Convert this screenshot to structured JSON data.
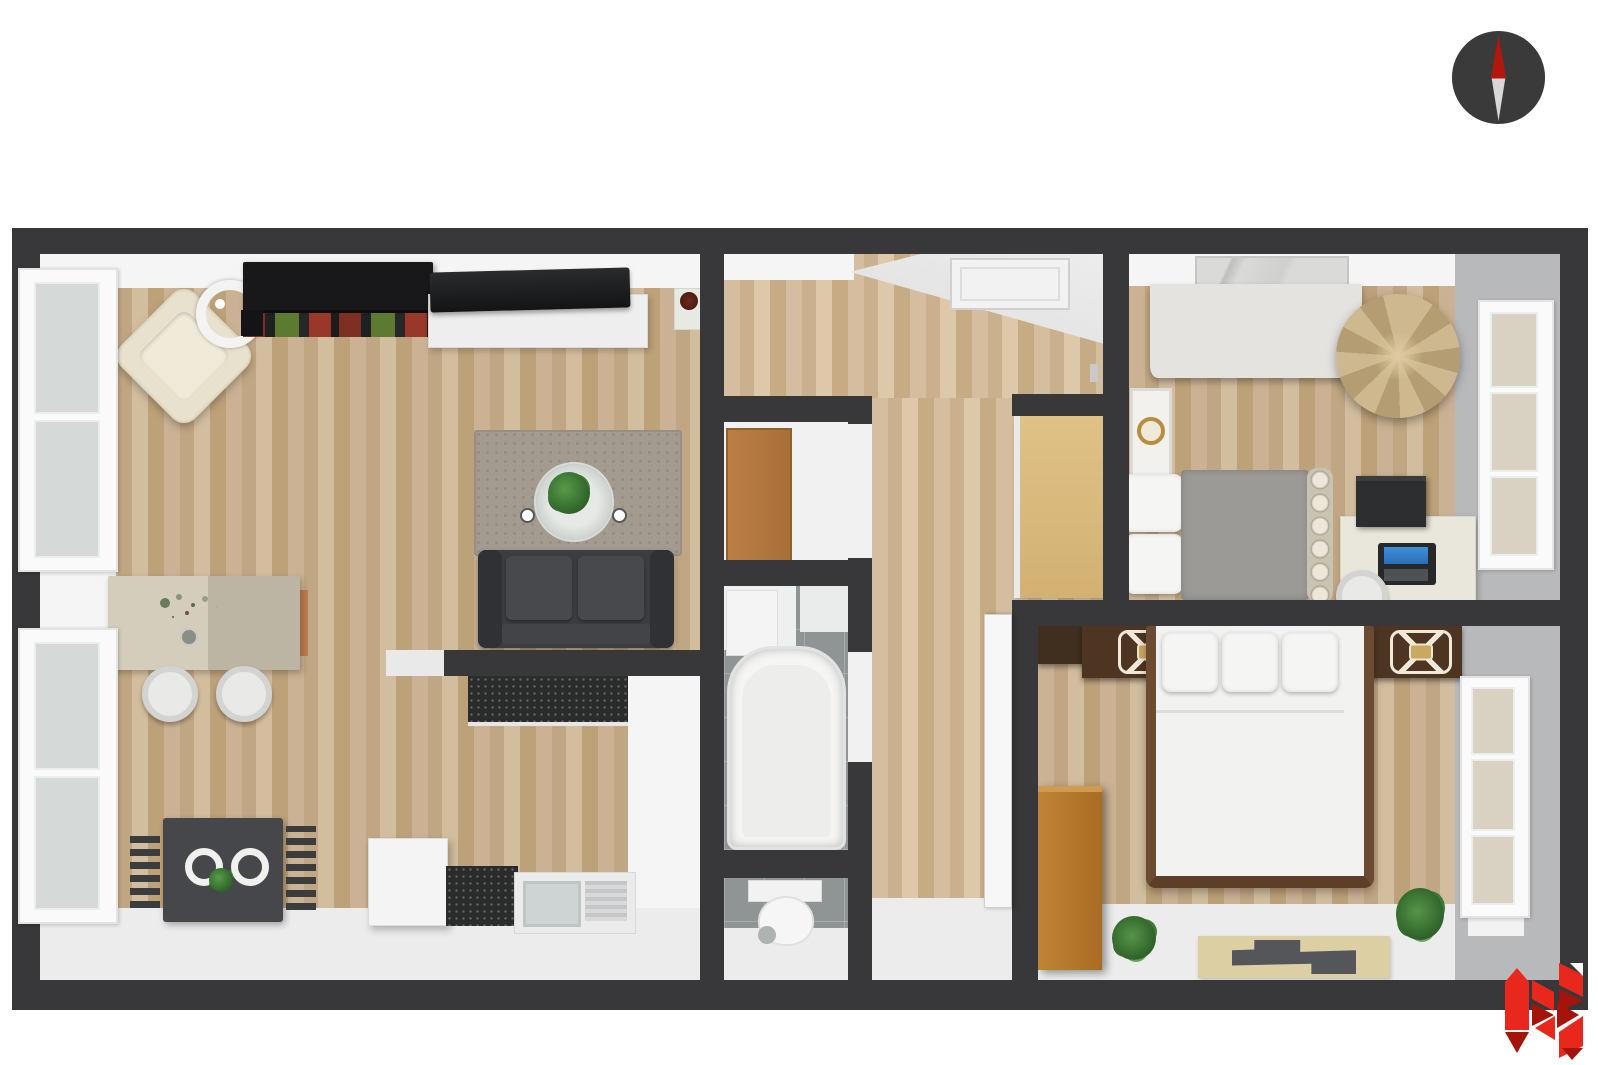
{
  "scene": {
    "type": "3d-floor-plan-top-view",
    "background_color": "#ffffff",
    "visible_text": "none"
  },
  "compass": {
    "label": "compass north indicator",
    "body_color": "#3a3a3b",
    "north_needle_color": "#b2170e",
    "south_needle_color": "#d7d7d7"
  },
  "logo": {
    "label": "red geometric monogram logo",
    "primary_color": "#e8281c",
    "shade_color": "#a5140b"
  },
  "palette": {
    "wall": "#38383a",
    "wood_floor": "#c5ab89",
    "tile_floor": "#8e9594",
    "white_floor": "#ececec",
    "wall_inner_face": "#f5f5f5",
    "right_wall_face": "#b8b9bb",
    "accent_red": "#e8281c",
    "sofa_gray": "#3b3d40",
    "armchair_cream": "#e7e1cd",
    "closet_door_wood": "#b07540",
    "wardrobe_orange": "#b5762f",
    "bean_bag_tan": "#c2ac82"
  },
  "rooms": {
    "living_room": {
      "label": "living room with kitchen",
      "furniture": [
        "armchair",
        "floor-lamp",
        "bookshelf",
        "speaker",
        "tv",
        "tv-unit",
        "plant-stand",
        "area-rug",
        "coffee-table-with-plant",
        "two-seat-sofa",
        "dining-table-with-flowers",
        "two-round-chairs",
        "breakfast-table",
        "two-plates",
        "table-plant",
        "two-slat-chairs",
        "white-cube",
        "black-counter",
        "sink-counter",
        "drainboard"
      ]
    },
    "entry_hall": {
      "label": "entry hall",
      "furniture": [
        "ceiling-vent",
        "door-handle"
      ]
    },
    "closet": {
      "label": "closet",
      "furniture": [
        "wooden-door-leaf"
      ]
    },
    "bathroom": {
      "label": "bathroom",
      "furniture": [
        "bathtub",
        "white-cabinet"
      ]
    },
    "wc": {
      "label": "wc",
      "furniture": [
        "toilet",
        "flush-button",
        "floor-mat"
      ]
    },
    "corridor": {
      "label": "corridor",
      "furniture": [
        "tall-tan-cabinet",
        "open-white-door"
      ]
    },
    "bedroom_small": {
      "label": "small bedroom",
      "furniture": [
        "wall-art",
        "dresser",
        "bean-bag",
        "wall-frame-with-gold-ring",
        "single-bed-gray-duvet",
        "pillow-stack",
        "spindle-footboard",
        "desk",
        "printer",
        "laptop",
        "round-chair",
        "window"
      ]
    },
    "bedroom_master": {
      "label": "master bedroom",
      "furniture": [
        "headboard-band",
        "nightstand-left",
        "nightstand-right",
        "table-lamp-left",
        "table-lamp-right",
        "double-bed-white-duvet",
        "three-pillows",
        "orange-wardrobe",
        "plant-left",
        "plant-right",
        "floor-mat-with-dark-shape",
        "window",
        "white-sill-panel"
      ]
    }
  }
}
